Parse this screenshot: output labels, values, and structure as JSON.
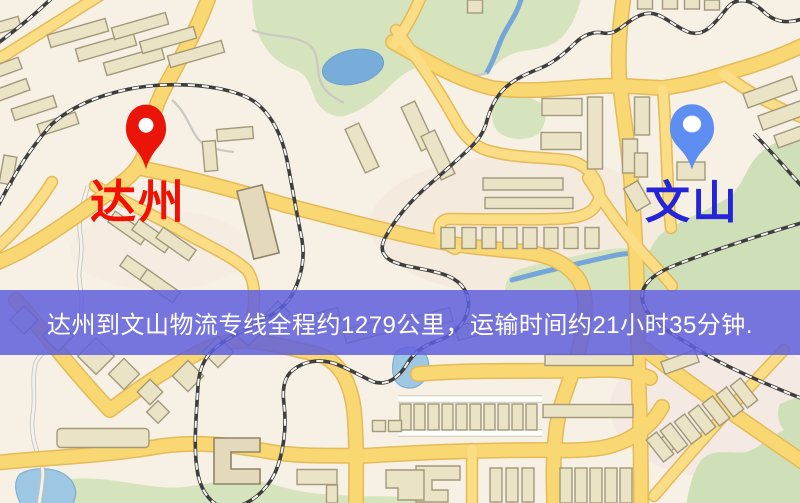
{
  "banner": {
    "text": "达州到文山物流专线全程约1279公里，运输时间约21小时35分钟.",
    "origin_city": "达州",
    "destination_city": "文山",
    "distance_km": "1279",
    "duration": "21小时35分钟",
    "background_color": "#5f5fdd",
    "text_color": "#ffffff"
  },
  "markers": {
    "origin": {
      "label": "达州",
      "pin_color": "#ea1408",
      "label_color": "#f21000"
    },
    "destination": {
      "label": "文山",
      "pin_color": "#5f8ef3",
      "label_color": "#2424d8"
    }
  },
  "map_colors": {
    "background": "#f6f0e5",
    "road_fill": "#f9d773",
    "road_casing": "#e5ba58",
    "building_fill": "#ebe3c6",
    "building_outline": "#a2997a",
    "park_green": "#d5e4bd",
    "water_blue": "#9ec7e4",
    "railway": "#3e3e3e"
  }
}
